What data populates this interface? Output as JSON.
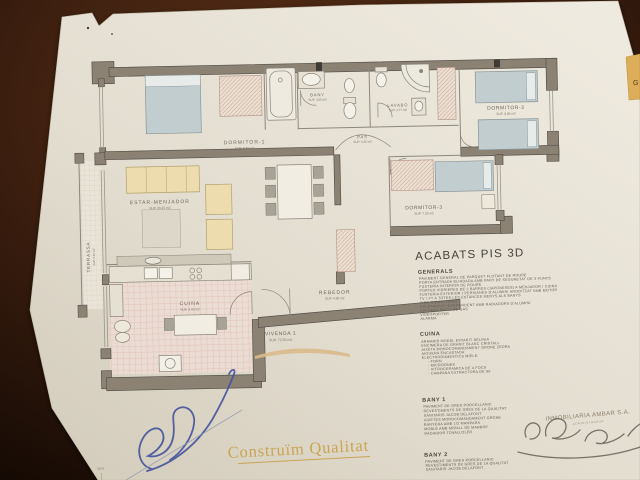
{
  "plan": {
    "title": "ACABATS PIS 3D",
    "rooms": {
      "dormitor1": {
        "label": "DORMITOR-1",
        "area": "SUP. 9.30 m2"
      },
      "dormitor2": {
        "label": "DORMITOR-2",
        "area": "SUP. 8.80 m2"
      },
      "dormitor3": {
        "label": "DORMITOR-3",
        "area": "SUP. 7.25 m2"
      },
      "bany": {
        "label": "BANY",
        "area": "SUP. 4.05 m2"
      },
      "lavabo": {
        "label": "LAVABO",
        "area": "SUP. 3.77 m2"
      },
      "pas": {
        "label": "PAS",
        "area": "SUP. 4.30 m2"
      },
      "estar": {
        "label": "ESTAR-MENJADOR",
        "area": "SUP. 20.15 m2"
      },
      "cuina": {
        "label": "CUINA",
        "area": "SUP. 8.40 m2"
      },
      "rebedor": {
        "label": "REBEDOR",
        "area": "SUP. 4.80 m2"
      },
      "terrassa": {
        "label": "TERRASSA",
        "area": "SUP. 6.40 m2"
      },
      "vivenda": {
        "label": "VIVENDA 1",
        "area": "SUP. 73.50 m2"
      }
    },
    "footer_mark": "GER"
  },
  "specs": {
    "title": "ACABATS PIS 3D",
    "generals": {
      "heading": "GENERALS",
      "lines": [
        "PAVIMENT GENERAL DE PARQUET FLOTANT DE ROURE",
        "PORTA ENTRADA BLINDADA AMB PANY DE SEGURETAT DE 3 PUNTS",
        "FUSTERIA INTERIOR DE ROURE",
        "PORTES VIDRIERES DE 2 BARRES (JAPONESES) A MENJADOR I CUINA",
        "FUSTERIA EXTERIOR I PERSIANES D'ALUMINI ANODITZAT AMB MOTOR",
        "TV I FT A TOTES LES ESTANCES MENYS ALS BANYS",
        "AIRE CONDICIONAT",
        "CALEFACCIO INDEPENDENT AMB RADIADORS D'ALUMINI",
        "CALDERA MIXTA DE GAS",
        "VIDEOPORTER",
        "ALARMA"
      ]
    },
    "cuina": {
      "heading": "CUINA",
      "lines": [
        "ARMARIS MODEL ESTARIT DELINIA",
        "ENCIMERA DE GRANIT BLANC CRISTALL",
        "AIXETA MONOCOMANDAMENT GROHE ZEDRA",
        "AIGUERA ENCASTADA",
        "ELECTRODOMESTICS MIELE:",
        "-  FORN",
        "-  MICROONES",
        "-  VITROCERAMICA DE 4 FOCS",
        "-  CAMPANA EXTRACTORA DE 90"
      ]
    },
    "bany1": {
      "heading": "BANY 1",
      "lines": [
        "PAVIMENT DE GRES PORCELLANIC",
        "REVESTIMENTS DE GRES DE 1A QUALITAT",
        "SANITARIS JACOB DELAFONT",
        "AIXETES MONOCOMANDAMENT GROHE",
        "BANYERA AMB 1/2 MAMPARA",
        "MOBLE AMB MIRALL DE MARBRE",
        "RADIADOR TOVALLOLER"
      ]
    },
    "bany2": {
      "heading": "BANY 2",
      "lines": [
        "PAVIMENT DE GRES PORCELLANIC",
        "REVESTIMENTS DE GRES DE 1A QUALITAT",
        "SANITARIS JACOB DELAFONT"
      ]
    }
  },
  "branding": {
    "slogan": "Construïm Qualitat"
  },
  "stamp": {
    "company": "INMOBILIARIA AMBAR S.A.",
    "subtext": "ADMINISTRADOR"
  },
  "side_tab": {
    "letter": "G"
  },
  "colors": {
    "wood": "#3f2010",
    "paper": "#e3ddd0",
    "wall": "#8b8274",
    "gold": "#c9a452",
    "pen_blue": "#44549e",
    "pencil": "#6e675c"
  }
}
